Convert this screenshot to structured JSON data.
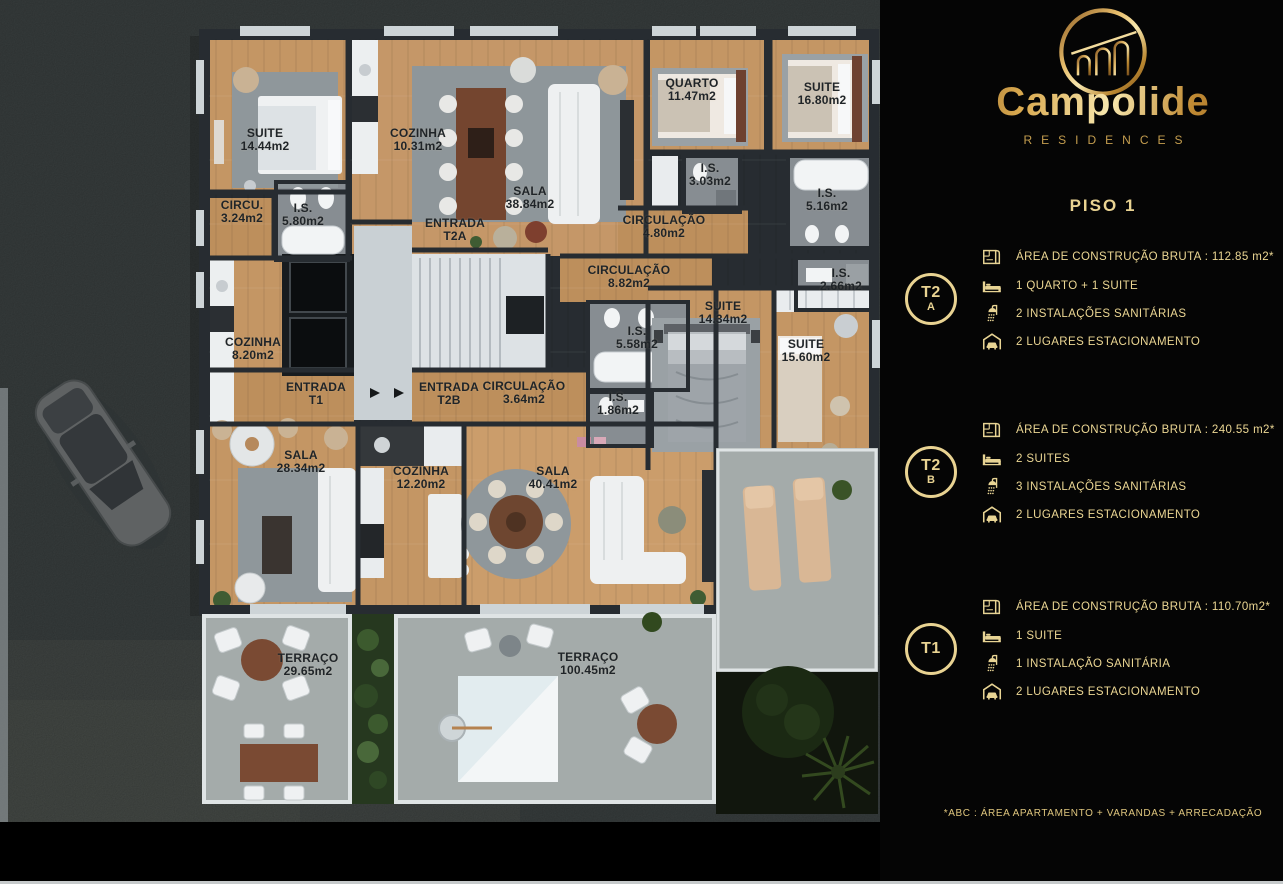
{
  "plan": {
    "rooms": [
      {
        "l1": "SUITE",
        "l2": "14.44m2"
      },
      {
        "l1": "COZINHA",
        "l2": "10.31m2"
      },
      {
        "l1": "SALA",
        "l2": "38.84m2"
      },
      {
        "l1": "QUARTO",
        "l2": "11.47m2"
      },
      {
        "l1": "SUITE",
        "l2": "16.80m2"
      },
      {
        "l1": "I.S.",
        "l2": "3.03m2"
      },
      {
        "l1": "I.S.",
        "l2": "5.16m2"
      },
      {
        "l1": "CIRCULAÇÃO",
        "l2": "4.80m2"
      },
      {
        "l1": "CIRCU.",
        "l2": "3.24m2"
      },
      {
        "l1": "I.S.",
        "l2": "5.80m2"
      },
      {
        "l1": "ENTRADA",
        "l2": "T2A"
      },
      {
        "l1": "CIRCULAÇÃO",
        "l2": "8.82m2"
      },
      {
        "l1": "I.S.",
        "l2": "2.66m2"
      },
      {
        "l1": "SUITE",
        "l2": "14.34m2"
      },
      {
        "l1": "COZINHA",
        "l2": "8.20m2"
      },
      {
        "l1": "I.S.",
        "l2": "5.58m2"
      },
      {
        "l1": "SUITE",
        "l2": "15.60m2"
      },
      {
        "l1": "ENTRADA",
        "l2": "T1"
      },
      {
        "l1": "ENTRADA",
        "l2": "T2B"
      },
      {
        "l1": "CIRCULAÇÃO",
        "l2": "3.64m2"
      },
      {
        "l1": "I.S.",
        "l2": "1.86m2"
      },
      {
        "l1": "SALA",
        "l2": "28.34m2"
      },
      {
        "l1": "COZINHA",
        "l2": "12.20m2"
      },
      {
        "l1": "SALA",
        "l2": "40.41m2"
      },
      {
        "l1": "TERRAÇO",
        "l2": "29.65m2"
      },
      {
        "l1": "TERRAÇO",
        "l2": "100.45m2"
      }
    ]
  },
  "sidebar": {
    "brand": {
      "name": "Campolide",
      "subtitle": "RESIDENCES",
      "logo_icon": "aqueduct-arches-icon"
    },
    "floor_title": "PISO 1",
    "units": [
      {
        "badge": "T2",
        "badge_sub": "A",
        "rows": [
          {
            "icon": "area-plan-icon",
            "text": "ÁREA DE CONSTRUÇÃO BRUTA :  112.85 m2*"
          },
          {
            "icon": "bed-icon",
            "text": "1 QUARTO + 1 SUITE"
          },
          {
            "icon": "shower-icon",
            "text": "2 INSTALAÇÕES SANITÁRIAS"
          },
          {
            "icon": "garage-car-icon",
            "text": "2 LUGARES ESTACIONAMENTO"
          }
        ]
      },
      {
        "badge": "T2",
        "badge_sub": "B",
        "rows": [
          {
            "icon": "area-plan-icon",
            "text": "ÁREA DE CONSTRUÇÃO BRUTA :  240.55 m2*"
          },
          {
            "icon": "bed-icon",
            "text": "2 SUITES"
          },
          {
            "icon": "shower-icon",
            "text": "3 INSTALAÇÕES SANITÁRIAS"
          },
          {
            "icon": "garage-car-icon",
            "text": "2 LUGARES ESTACIONAMENTO"
          }
        ]
      },
      {
        "badge": "T1",
        "badge_sub": "",
        "rows": [
          {
            "icon": "area-plan-icon",
            "text": "ÁREA DE CONSTRUÇÃO BRUTA :  110.70m2*"
          },
          {
            "icon": "bed-icon",
            "text": "1 SUITE"
          },
          {
            "icon": "shower-icon",
            "text": "1 INSTALAÇÃO SANITÁRIA"
          },
          {
            "icon": "garage-car-icon",
            "text": "2 LUGARES ESTACIONAMENTO"
          }
        ]
      }
    ],
    "footnote": "*ABC :  ÁREA APARTAMENTO + VARANDAS + ARRECADAÇÃO"
  },
  "colors": {
    "gold": "#e9d392",
    "gold_dark": "#9a7734",
    "wood": "#c49664",
    "wall": "#272c31",
    "street": "#3b4141",
    "concrete": "#a4abaa",
    "background": "#000000"
  }
}
